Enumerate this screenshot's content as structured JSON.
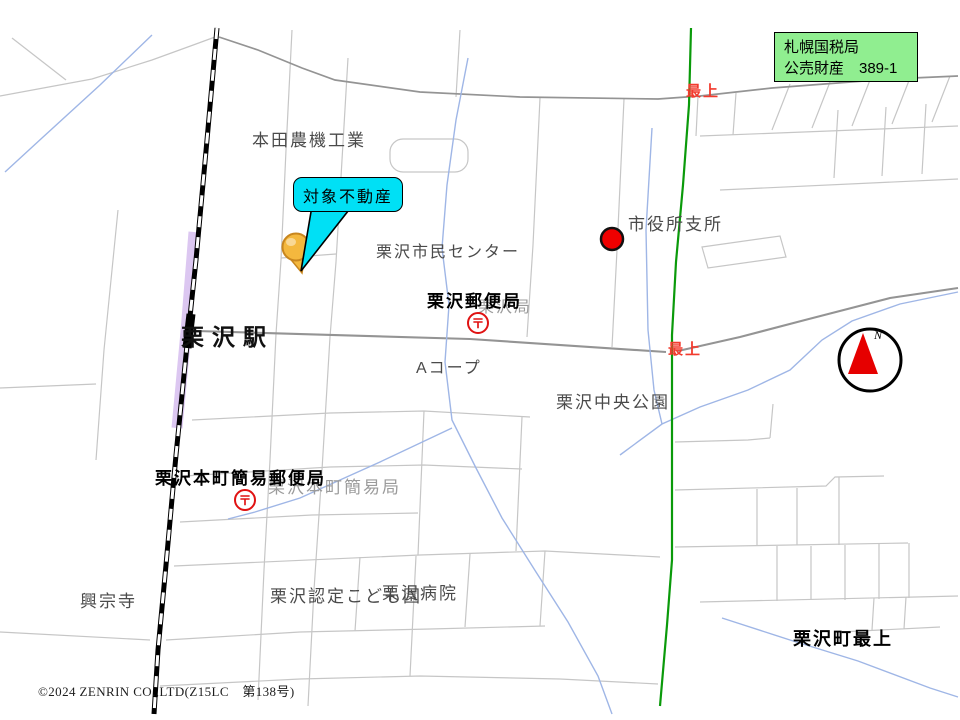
{
  "annotation_box": {
    "line1": "札幌国税局",
    "line2": "公売財産　389-1"
  },
  "callout": {
    "text": "対象不動産"
  },
  "compass": {
    "north": "N"
  },
  "post_office_mark": "〒",
  "copyright": "©2024 ZENRIN CO.,LTD(Z15LC　第138号)",
  "colors": {
    "annotation_green": "#90ee90",
    "callout_cyan": "#00e0f5",
    "boundary_green": "#0a9a0a",
    "water_blue": "#9fb6e6",
    "rail_purple": "#dcc7f1",
    "road_light": "#c6c6c6",
    "road_main": "#949494",
    "marker_red": "#ee0000",
    "pin_orange": "#f4b83e",
    "road_red_text": "#f23b2e"
  },
  "labels": [
    {
      "id": "honda-nouki-kogyo",
      "text": "本田農機工業",
      "x": 252,
      "y": 132,
      "size": 17,
      "kind": "place"
    },
    {
      "id": "shimin-center",
      "text": "栗沢市民センター",
      "x": 376,
      "y": 245,
      "size": 16,
      "kind": "place"
    },
    {
      "id": "shiyakusho-shisho",
      "text": "市役所支所",
      "x": 628,
      "y": 216,
      "size": 17,
      "kind": "place"
    },
    {
      "id": "yubinkyoku-ghost",
      "text": "栗沢局",
      "x": 478,
      "y": 300,
      "size": 16,
      "kind": "ghost"
    },
    {
      "id": "kurisawa-yubinkyoku",
      "text": "栗沢郵便局",
      "x": 427,
      "y": 293,
      "size": 17,
      "kind": "bold"
    },
    {
      "id": "kurisawa-station",
      "text": "栗沢駅",
      "x": 181,
      "y": 326,
      "size": 23,
      "kind": "station"
    },
    {
      "id": "a-coop",
      "text": "Aコープ",
      "x": 416,
      "y": 361,
      "size": 16,
      "kind": "place"
    },
    {
      "id": "chuo-koen",
      "text": "栗沢中央公園",
      "x": 556,
      "y": 394,
      "size": 17,
      "kind": "place"
    },
    {
      "id": "honcho-kanni-ghost",
      "text": "栗沢本町簡易局",
      "x": 268,
      "y": 479,
      "size": 17,
      "kind": "ghost"
    },
    {
      "id": "honcho-kanni-yubinkyoku",
      "text": "栗沢本町簡易郵便局",
      "x": 155,
      "y": 470,
      "size": 17,
      "kind": "bold"
    },
    {
      "id": "koshu-ji",
      "text": "興宗寺",
      "x": 80,
      "y": 593,
      "size": 17,
      "kind": "place"
    },
    {
      "id": "nintei-kodomoen",
      "text": "栗沢認定こども園",
      "x": 270,
      "y": 588,
      "size": 17,
      "kind": "place"
    },
    {
      "id": "kurisawa-byoin",
      "text": "栗沢病院",
      "x": 382,
      "y": 585,
      "size": 17,
      "kind": "place"
    },
    {
      "id": "kurisawa-cho-mogami",
      "text": "栗沢町最上",
      "x": 793,
      "y": 630,
      "size": 18,
      "kind": "district"
    },
    {
      "id": "mogami-north",
      "text": "最上",
      "x": 686,
      "y": 84,
      "size": 15,
      "kind": "red"
    },
    {
      "id": "mogami-mid",
      "text": "最上",
      "x": 668,
      "y": 342,
      "size": 15,
      "kind": "red"
    }
  ]
}
